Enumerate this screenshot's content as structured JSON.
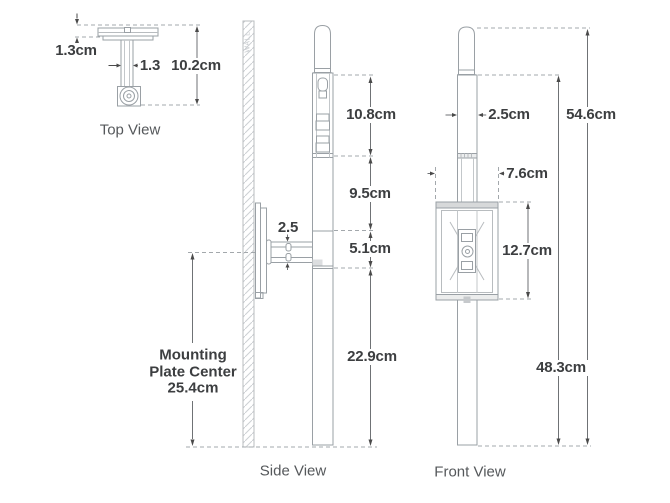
{
  "figure": {
    "type": "product-dimension-diagram",
    "units": "cm"
  },
  "colors": {
    "background": "#ffffff",
    "fixture_line": "#9aa0a5",
    "light_line": "#c3c7ca",
    "dimension_line": "#6f7275",
    "arrow": "#4a4a4a",
    "text": "#3c3e40",
    "title_text": "#55585b",
    "wall_text": "#c6cacd",
    "panel_fill": "#d7d9da"
  },
  "top_view": {
    "title": "Top View",
    "dims": {
      "plate_thickness": "1.3cm",
      "stem_width": "1.3",
      "overall_depth": "10.2cm"
    }
  },
  "side_view": {
    "title": "Side View",
    "wall_label": "WALL",
    "dims": {
      "upper_section": "10.8cm",
      "mid_section": "9.5cm",
      "bracket_section": "5.1cm",
      "lower_section": "22.9cm",
      "arm_thickness": "2.5"
    },
    "mounting": {
      "line1": "Mounting",
      "line2": "Plate Center",
      "line3": "25.4cm"
    }
  },
  "front_view": {
    "title": "Front View",
    "dims": {
      "post_width": "2.5cm",
      "overall_height": "54.6cm",
      "shaft_height": "48.3cm",
      "box_width": "7.6cm",
      "box_height": "12.7cm"
    }
  }
}
